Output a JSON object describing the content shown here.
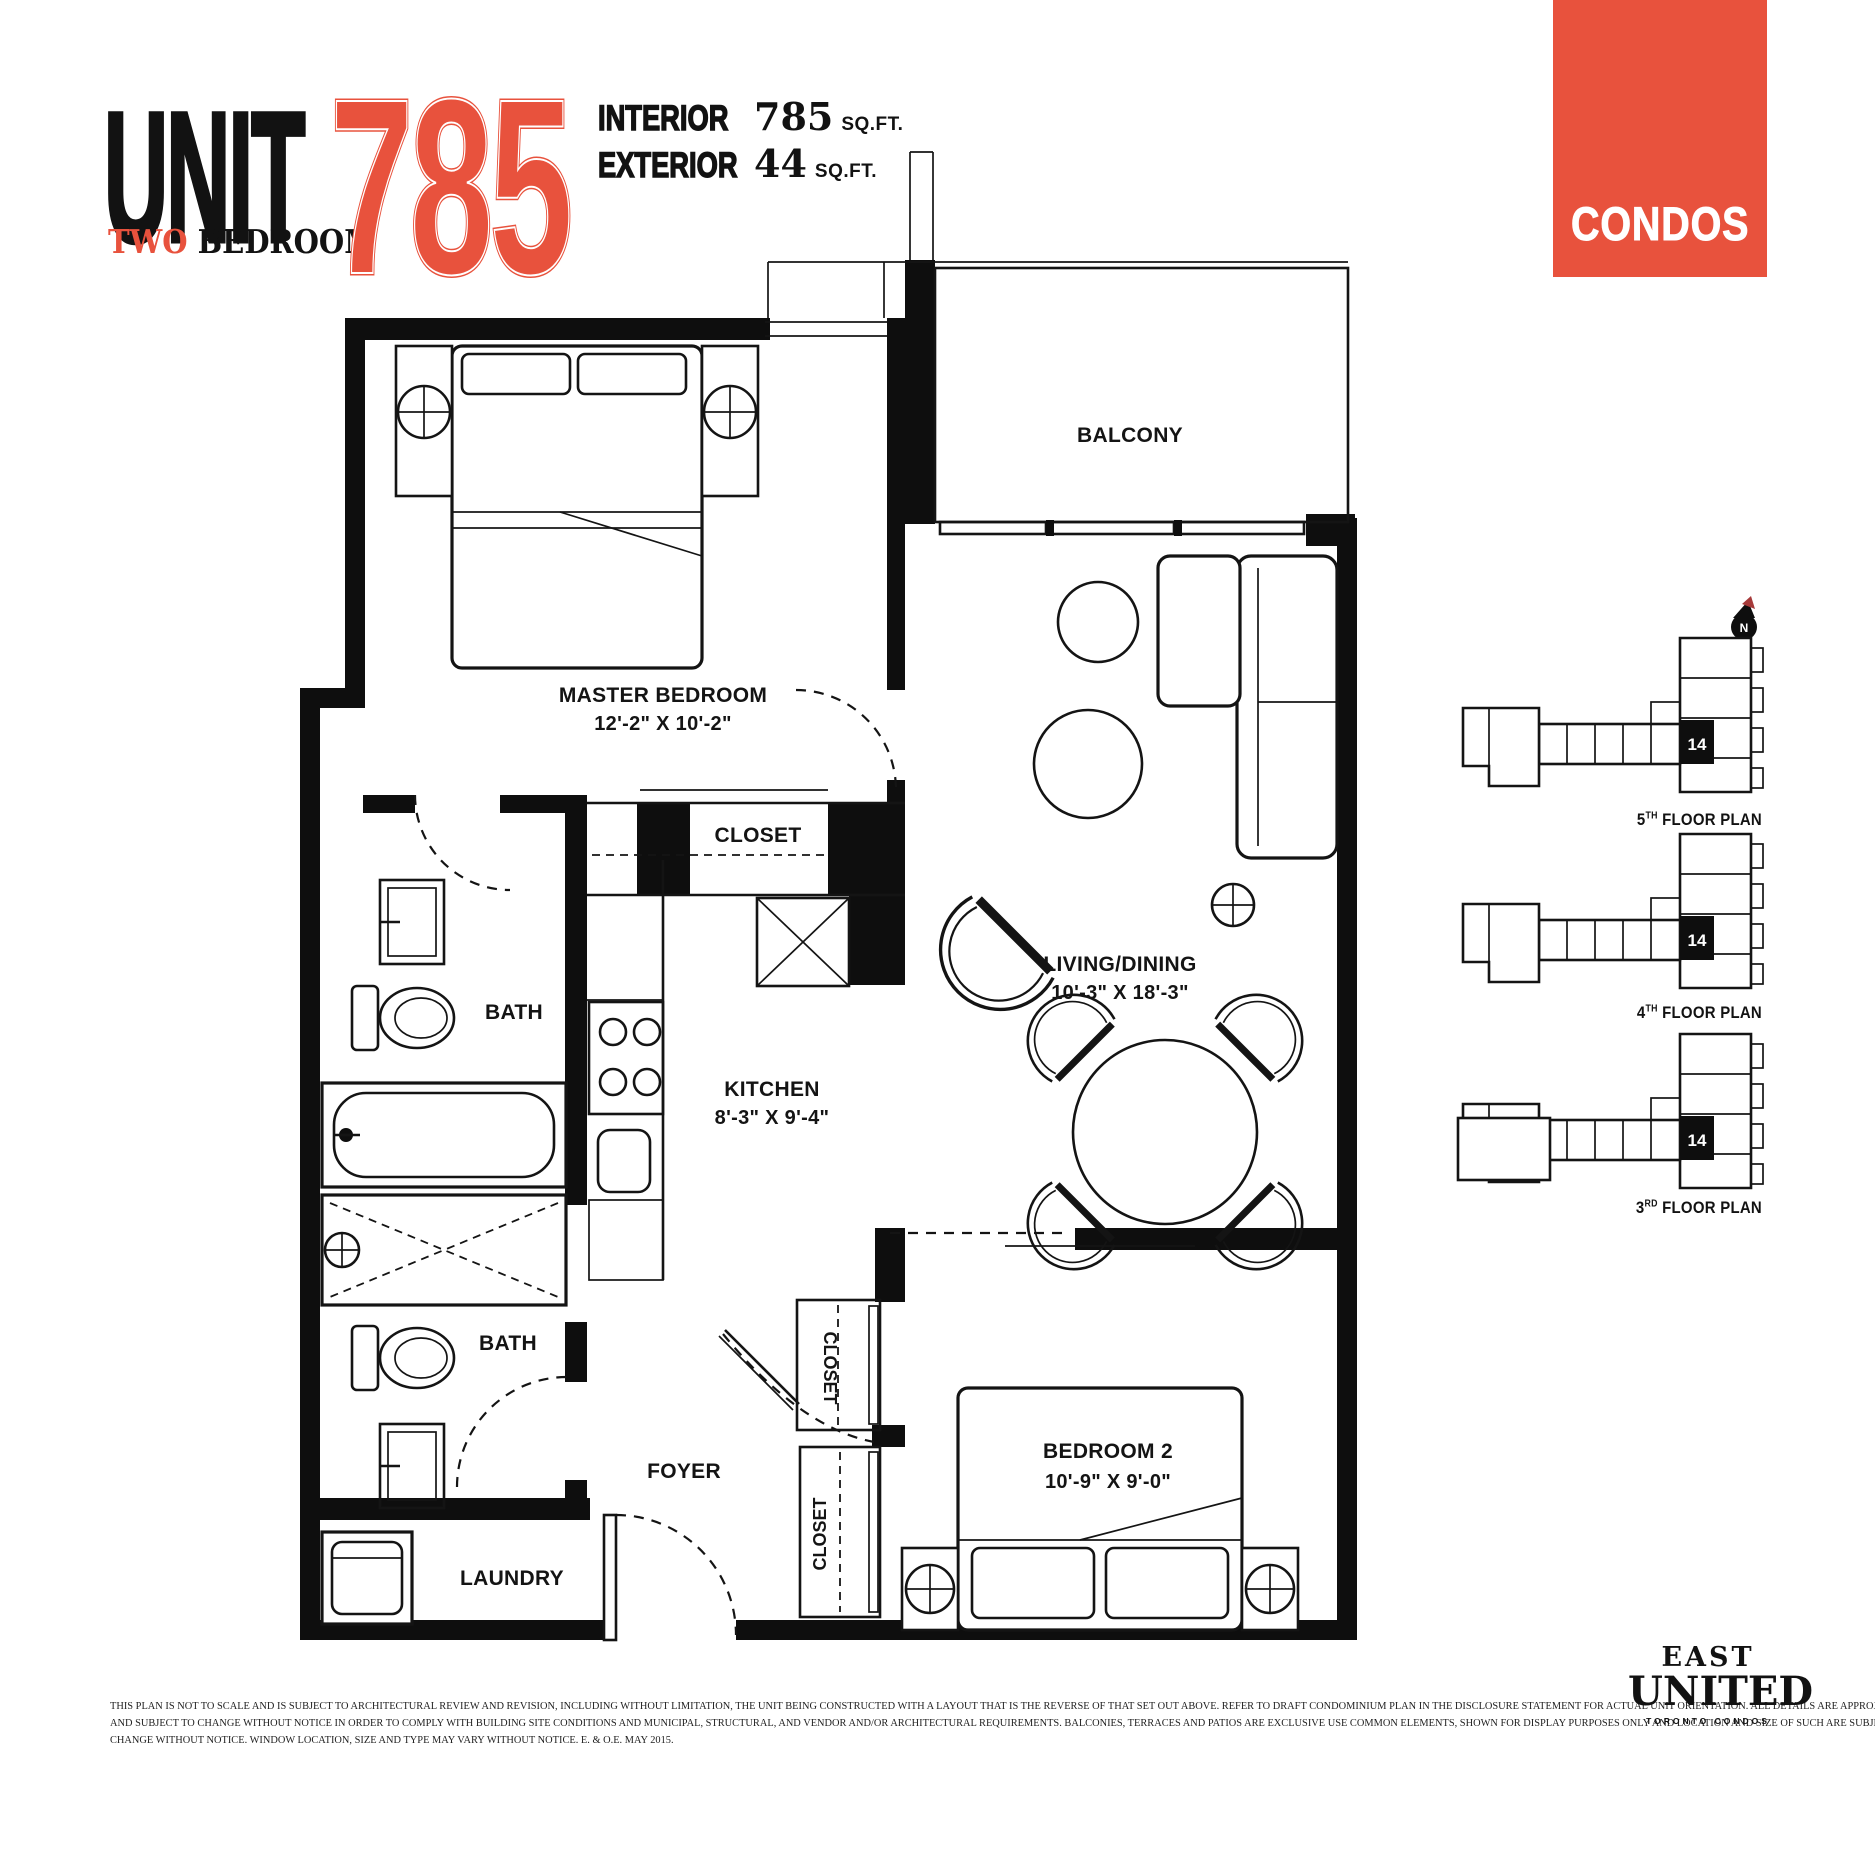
{
  "colors": {
    "accent": "#e8523d",
    "ink": "#121212"
  },
  "header": {
    "unit_label": "UNIT",
    "unit_type_accent": "TWO",
    "unit_type_rest": " BEDROOM",
    "unit_number": "785",
    "stats": [
      {
        "label": "INTERIOR",
        "value": "785",
        "unit": "SQ.FT."
      },
      {
        "label": "EXTERIOR",
        "value": "44",
        "unit": "SQ.FT."
      }
    ]
  },
  "badge": {
    "label": "CONDOS"
  },
  "floorplan": {
    "master": {
      "name": "MASTER BEDROOM",
      "dims": "12'-2\" X 10'-2\""
    },
    "balcony": {
      "name": "BALCONY"
    },
    "living": {
      "name": "LIVING/DINING",
      "dims": "10'-3\" X 18'-3\""
    },
    "kitchen": {
      "name": "KITCHEN",
      "dims": "8'-3\" X 9'-4\""
    },
    "bath1": {
      "name": "BATH"
    },
    "bath2": {
      "name": "BATH"
    },
    "foyer": {
      "name": "FOYER"
    },
    "laundry": {
      "name": "LAUNDRY"
    },
    "closet_master": {
      "name": "CLOSET"
    },
    "closet_hall": {
      "name": "CLOSET"
    },
    "closet_bed2": {
      "name": "CLOSET"
    },
    "bedroom2": {
      "name": "BEDROOM 2",
      "dims": "10'-9\" X 9'-0\""
    }
  },
  "keyplans": {
    "north_label": "N",
    "items": [
      {
        "num": "5",
        "ord": "TH",
        "rest": " FLOOR PLAN",
        "unit": "14"
      },
      {
        "num": "4",
        "ord": "TH",
        "rest": " FLOOR PLAN",
        "unit": "14"
      },
      {
        "num": "3",
        "ord": "RD",
        "rest": " FLOOR PLAN",
        "unit": "14"
      }
    ]
  },
  "footer": {
    "disclaimer_lines": [
      "THIS PLAN IS NOT TO SCALE AND IS SUBJECT TO ARCHITECTURAL REVIEW AND REVISION, INCLUDING WITHOUT LIMITATION, THE UNIT BEING CONSTRUCTED WITH A LAYOUT THAT IS THE REVERSE OF THAT SET OUT ABOVE. REFER TO DRAFT CONDOMINIUM PLAN IN THE DISCLOSURE STATEMENT FOR ACTUAL UNIT ORIENTATION. ALL DETAILS ARE APPROXIMATE",
      "AND SUBJECT TO CHANGE WITHOUT NOTICE IN ORDER TO COMPLY WITH BUILDING SITE CONDITIONS AND MUNICIPAL, STRUCTURAL, AND VENDOR AND/OR ARCHITECTURAL REQUIREMENTS. BALCONIES, TERRACES AND PATIOS ARE EXCLUSIVE USE COMMON ELEMENTS, SHOWN FOR DISPLAY PURPOSES ONLY AND LOCATION AND SIZE OF SUCH ARE SUBJECT TO",
      "CHANGE WITHOUT NOTICE. WINDOW LOCATION, SIZE AND TYPE MAY VARY WITHOUT NOTICE. E. & O.E. MAY 2015."
    ],
    "logo": {
      "line1": "EAST",
      "line2": "UNITED",
      "line3": "TORONTO CONDOS"
    }
  }
}
